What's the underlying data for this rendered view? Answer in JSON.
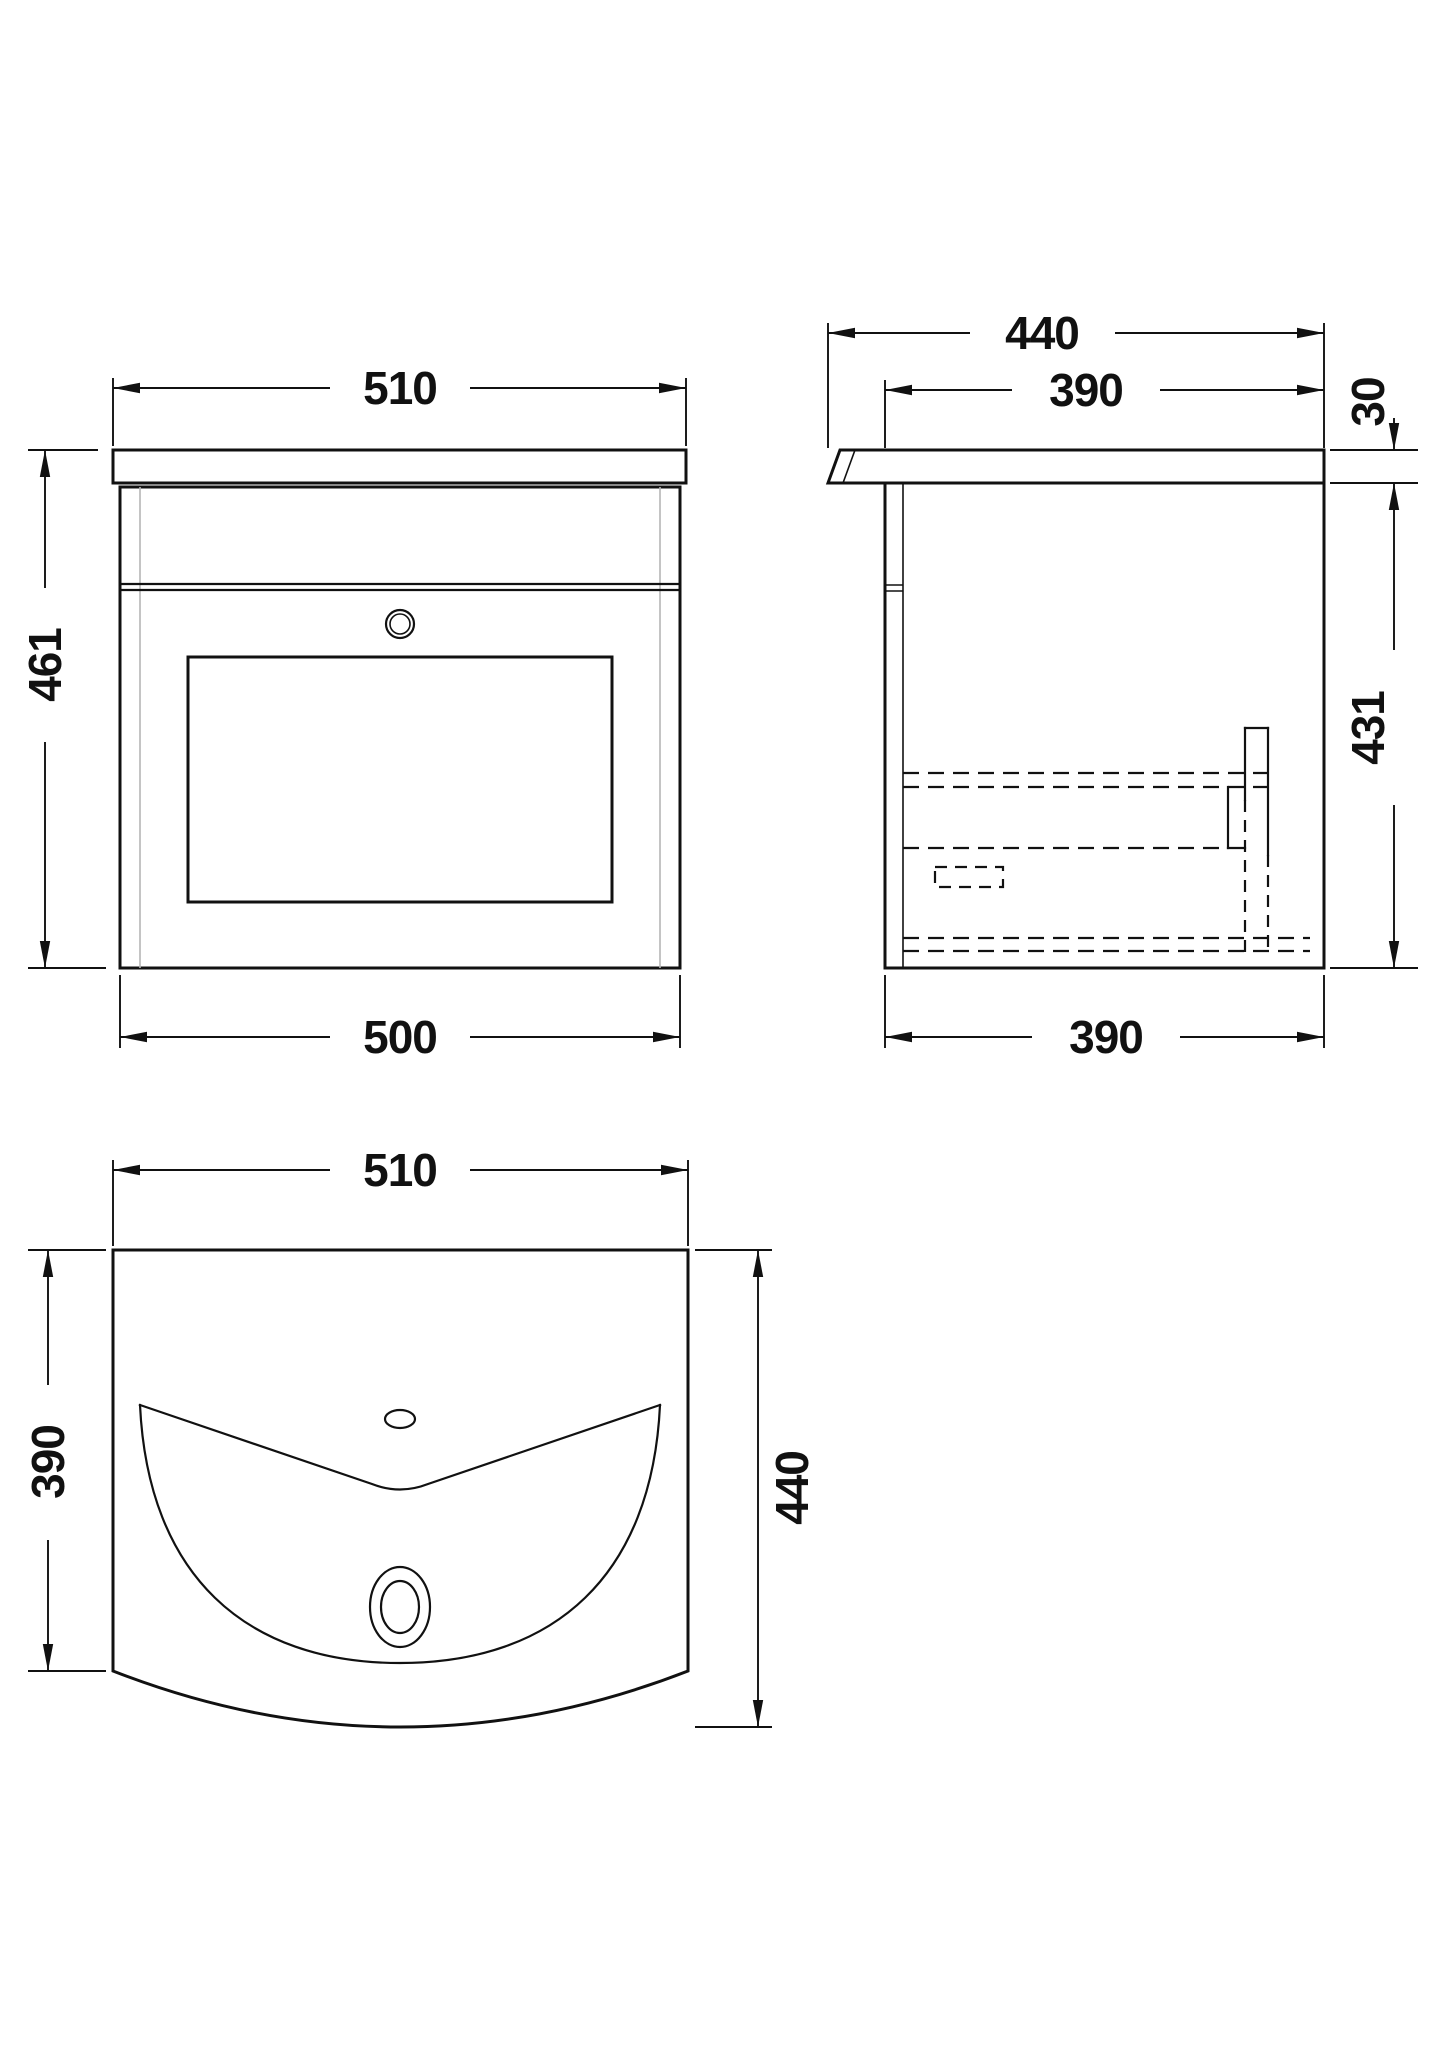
{
  "canvas": {
    "background": "#ffffff",
    "line_color": "#111111",
    "thin_line_color": "#b5b5b5"
  },
  "views": {
    "front": {
      "dims": {
        "width_top": "510",
        "height": "461",
        "width_bottom": "500"
      }
    },
    "side": {
      "dims": {
        "depth_overall": "440",
        "depth_top": "390",
        "counter_thickness": "30",
        "body_height": "431",
        "depth_bottom": "390"
      }
    },
    "plan": {
      "dims": {
        "width": "510",
        "depth_side": "390",
        "depth_overall": "440"
      }
    }
  }
}
